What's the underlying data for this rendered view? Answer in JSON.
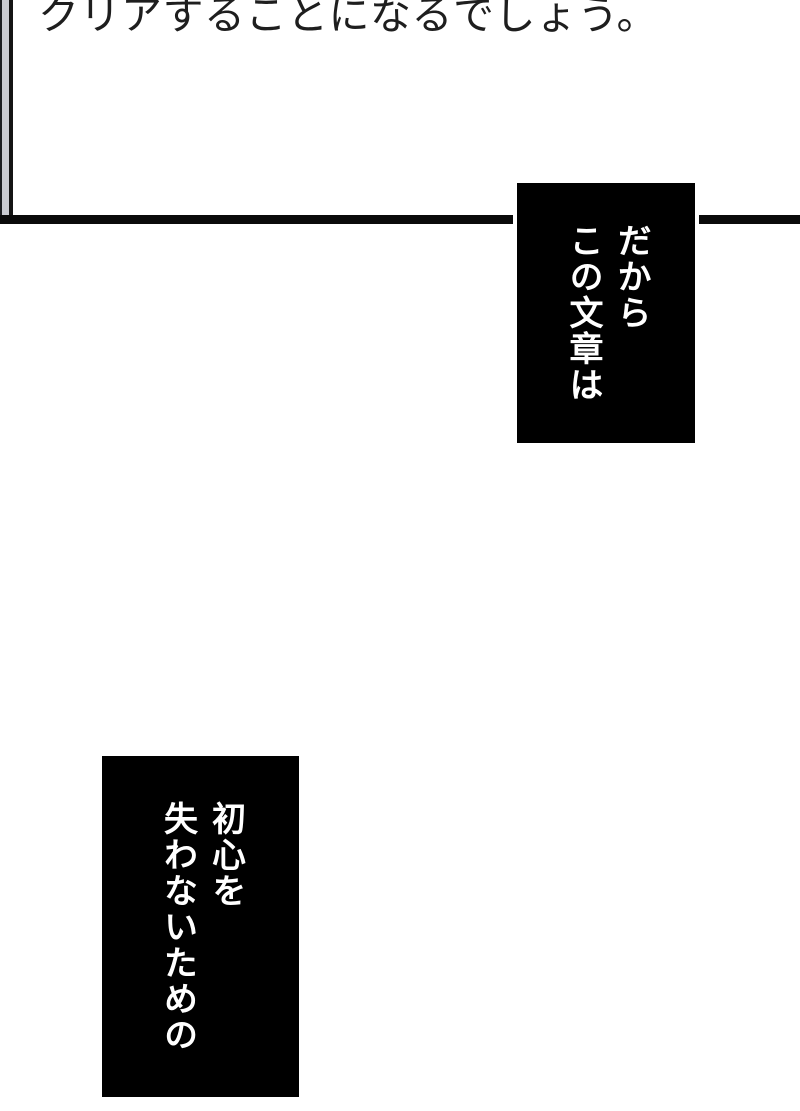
{
  "page": {
    "background_color": "#ffffff",
    "top_panel": {
      "narration": "クリアすることになるでしょう。",
      "text_color": "#1e1e1e",
      "border_color": "#0a0a0a",
      "gutter_gray": "#c9cbd1"
    },
    "caption_top_right": {
      "col1": "だから",
      "col2": "この文章は",
      "bg_color": "#000000",
      "text_color": "#ffffff"
    },
    "caption_bottom_left": {
      "col1": "初心を",
      "col2": "失わないための",
      "bg_color": "#000000",
      "text_color": "#ffffff"
    }
  }
}
